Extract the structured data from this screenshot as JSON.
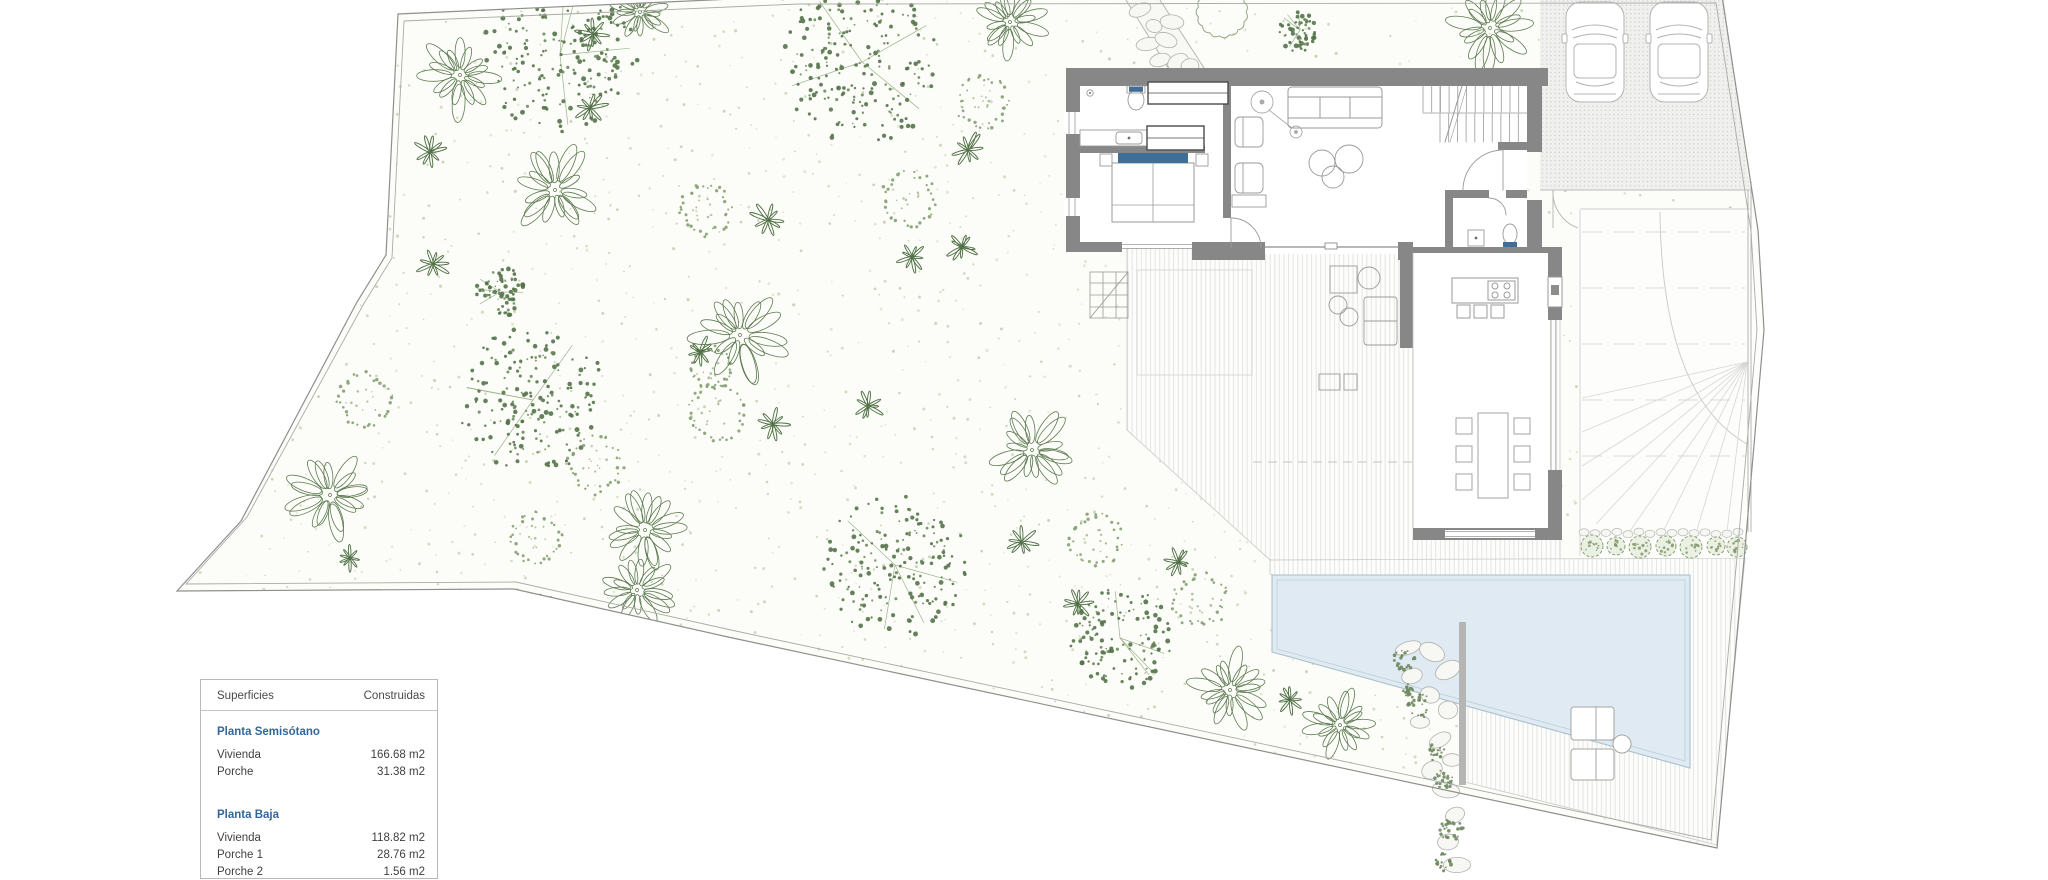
{
  "legend": {
    "header": {
      "col1": "Superficies",
      "col2": "Construidas"
    },
    "sections": [
      {
        "title": "Planta Semisótano",
        "rows": [
          {
            "label": "Vivienda",
            "value": "166.68 m2"
          },
          {
            "label": "Porche",
            "value": "31.38 m2"
          }
        ]
      },
      {
        "title": "Planta Baja",
        "rows": [
          {
            "label": "Vivienda",
            "value": "118.82 m2"
          },
          {
            "label": "Porche 1",
            "value": "28.76 m2"
          },
          {
            "label": "Porche 2",
            "value": "1.56 m2"
          }
        ]
      }
    ]
  },
  "colors": {
    "accent_blue": "#33679b",
    "furniture_blue": "#3f6f96",
    "pool_fill": "#dfeaf2",
    "pool_edge": "#a9bfcc",
    "wall_gray": "#878787",
    "tree_dark": "#54734a",
    "tree_light": "#85a073",
    "ground_stipple": "#ccd6bb"
  }
}
